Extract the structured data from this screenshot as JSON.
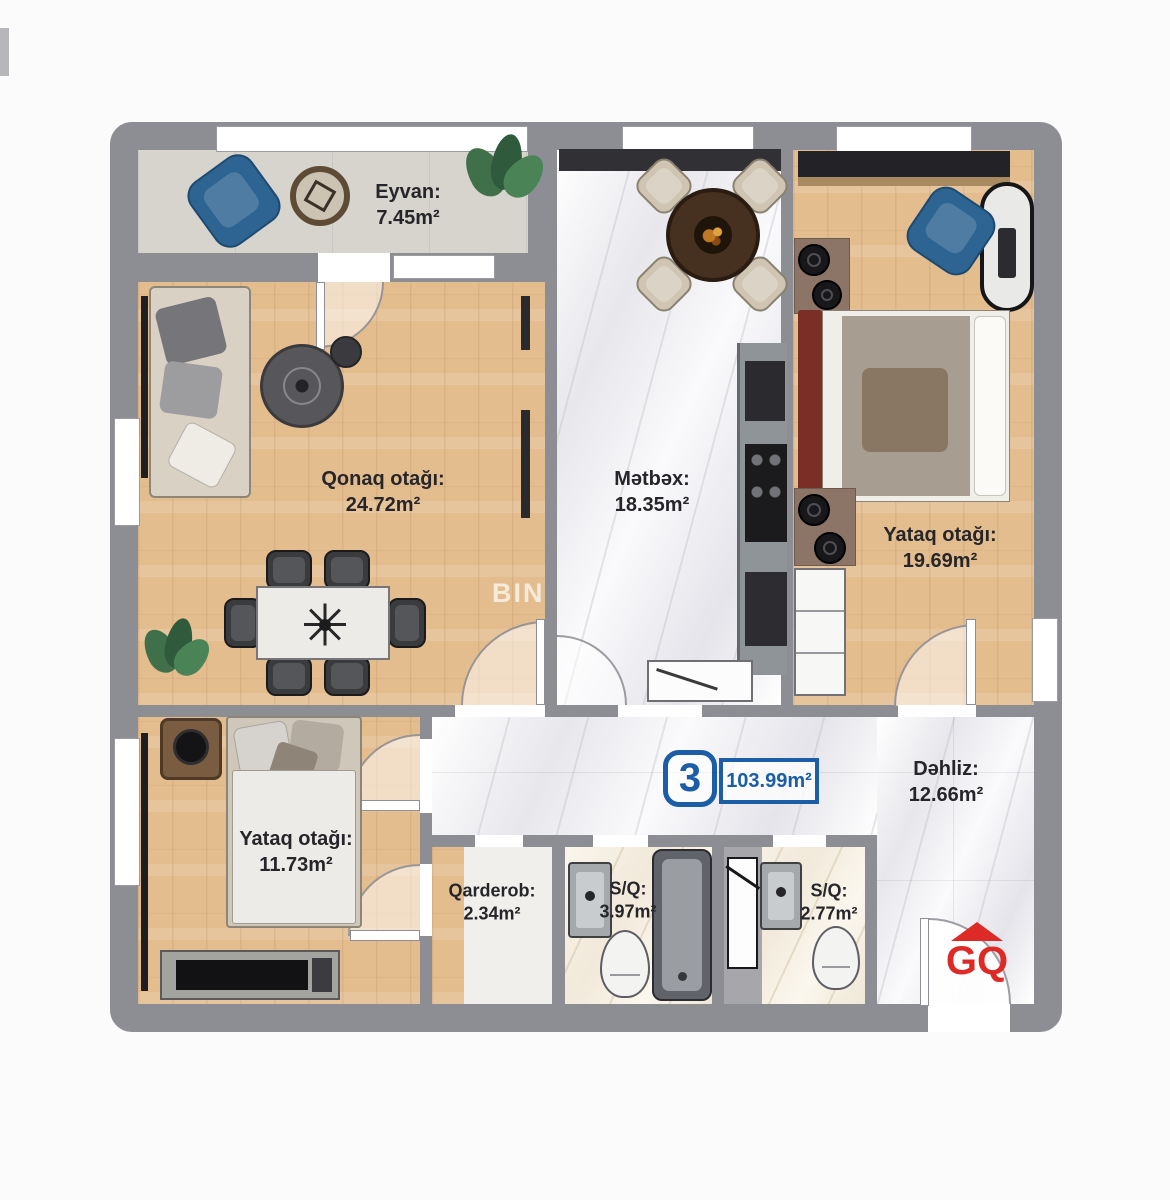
{
  "plan": {
    "rooms": [
      {
        "id": "eyvan",
        "name": "Eyvan:",
        "area": "7.45m²"
      },
      {
        "id": "qonaq",
        "name": "Qonaq otağı:",
        "area": "24.72m²"
      },
      {
        "id": "metbex",
        "name": "Mətbəx:",
        "area": "18.35m²"
      },
      {
        "id": "yataq1",
        "name": "Yataq otağı:",
        "area": "19.69m²"
      },
      {
        "id": "dehliz",
        "name": "Dəhliz:",
        "area": "12.66m²"
      },
      {
        "id": "yataq2",
        "name": "Yataq otağı:",
        "area": "11.73m²"
      },
      {
        "id": "qarderob",
        "name": "Qarderob:",
        "area": "2.34m²"
      },
      {
        "id": "sq1",
        "name": "S/Q:",
        "area": "3.97m²"
      },
      {
        "id": "sq2",
        "name": "S/Q:",
        "area": "2.77m²"
      }
    ],
    "badge": {
      "number": "3",
      "total_area": "103.99m²"
    },
    "logo": {
      "text": "GQ"
    },
    "watermark": "BIN",
    "colors": {
      "wall": "#8d8d94",
      "accent_blue": "#1b5ea6",
      "logo_red": "#de2a26",
      "wood": "#e4bd8e",
      "marble": "#ededf0",
      "balcony_floor": "#d7d4ce",
      "bath_marble": "#f3ecdd"
    }
  }
}
